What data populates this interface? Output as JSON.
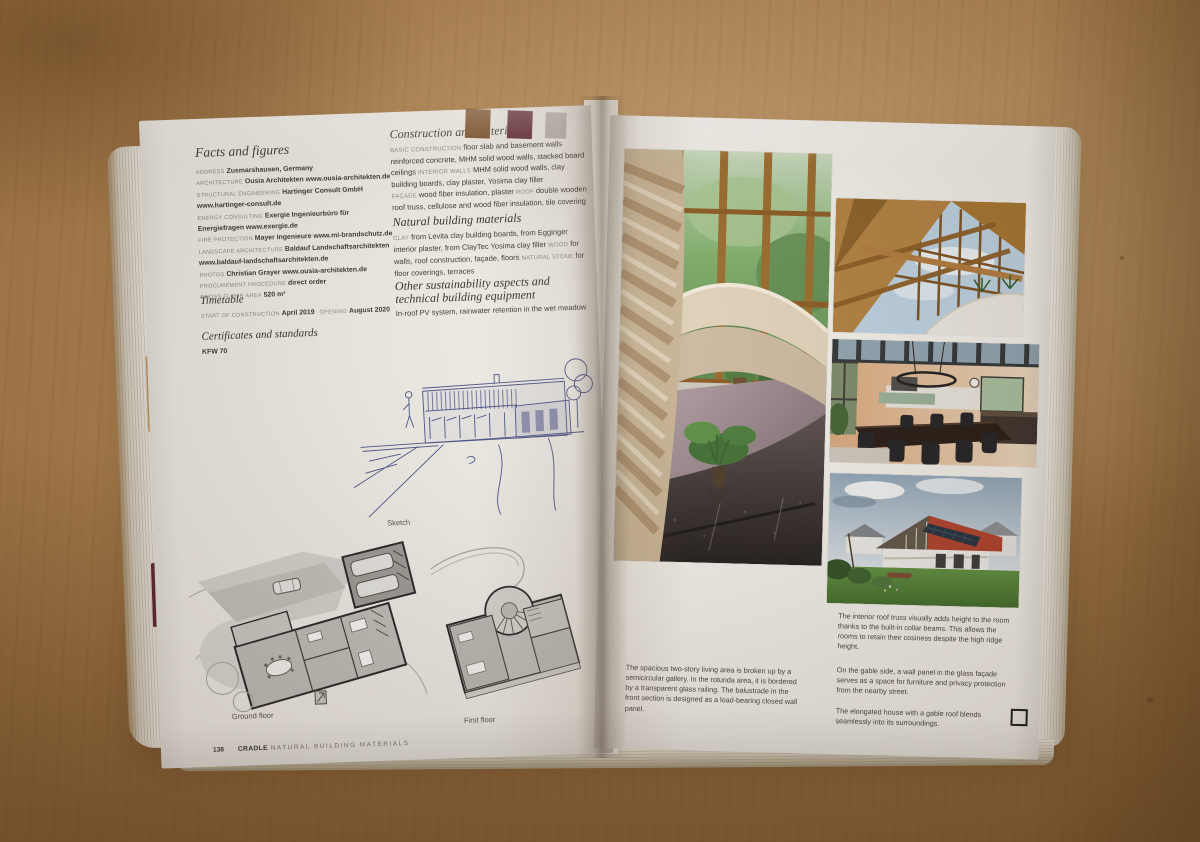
{
  "swatches": {
    "top_marks": [
      "#7a4d24",
      "#5f2531",
      "#b7b4ae"
    ],
    "edge_tab_tan": "#bf9864",
    "edge_tab_maroon": "#5c2531"
  },
  "left_page": {
    "facts_heading": "Facts and figures",
    "facts": [
      {
        "label": "ADDRESS",
        "value": "Zusmarshausen, Germany"
      },
      {
        "label": "ARCHITECTURE",
        "value": "Ousia Architekten www.ousia-architekten.de"
      },
      {
        "label": "STRUCTURAL ENGINEERING",
        "value": "Hartinger Consult GmbH www.hartinger-consult.de"
      },
      {
        "label": "ENERGY CONSULTING",
        "value": "Exergie Ingenieurbüro für Energiefragen www.exergie.de"
      },
      {
        "label": "FIRE PROTECTION",
        "value": "Mayer Ingenieure www.mi-brandschutz.de"
      },
      {
        "label": "LANDSCAPE ARCHITECTURE",
        "value": "Baldauf Landschaftsarchitekten www.baldauf-landschaftsarchitekten.de"
      },
      {
        "label": "PHOTOS",
        "value": "Christian Grayer www.ousia-architekten.de"
      },
      {
        "label": "PROCUREMENT PROCEDURE",
        "value": "direct order"
      },
      {
        "label": "GROSS FLOOR AREA",
        "value": "520 m²"
      }
    ],
    "timetable_heading": "Timetable",
    "timetable": [
      {
        "label": "START OF CONSTRUCTION",
        "value": "April 2019"
      },
      {
        "label": "OPENING",
        "value": "August 2020"
      }
    ],
    "certificates_heading": "Certificates and standards",
    "certificates_value": "KFW 70",
    "construction_heading": "Construction and materials",
    "construction_runs": [
      {
        "label": "BASIC CONSTRUCTION",
        "text": "floor slab and basement walls reinforced concrete, MHM solid wood walls, stacked board ceilings"
      },
      {
        "label": "INTERIOR WALLS",
        "text": "MHM solid wood walls, clay building boards, clay plaster, Yosima clay filler"
      },
      {
        "label": "FAÇADE",
        "text": "wood fiber insulation, plaster"
      },
      {
        "label": "ROOF",
        "text": "double wooden roof truss, cellulose and wood fiber insulation, tile covering"
      }
    ],
    "natural_heading": "Natural building materials",
    "natural_runs": [
      {
        "label": "CLAY",
        "text": "from Levita clay building boards, from Egginger interior plaster, from ClayTec Yosima clay filler"
      },
      {
        "label": "WOOD",
        "text": "for walls, roof construction, façade, floors"
      },
      {
        "label": "NATURAL STONE",
        "text": "for floor coverings, terraces"
      }
    ],
    "sustainability_heading": "Other sustainability aspects and technical building equipment",
    "sustainability_text": "In-roof PV system, rainwater retention in the wet meadow",
    "sketch_label": "Sketch",
    "ground_floor_label": "Ground floor",
    "first_floor_label": "First floor",
    "page_number": "138",
    "footer_brand": "CRADLE",
    "footer_title": "NATURAL BUILDING MATERIALS"
  },
  "right_page": {
    "caption_rotunda": "The spacious two-story living area is broken up by a semicircular gallery. In the rotunda area, it is bordered by a transparent glass railing. The balustrade in the front section is designed as a load-bearing closed wall panel.",
    "caption_roof_truss": "The interior roof truss visually adds height to the room thanks to the built-in collar beams. This allows the rooms to retain their cosiness despite the high ridge height.",
    "caption_gable": "On the gable side, a wall panel in the glass façade serves as a space for furniture and privacy protection from the nearby street.",
    "caption_exterior": "The elongated house with a gable roof blends seamlessly into its surroundings."
  }
}
